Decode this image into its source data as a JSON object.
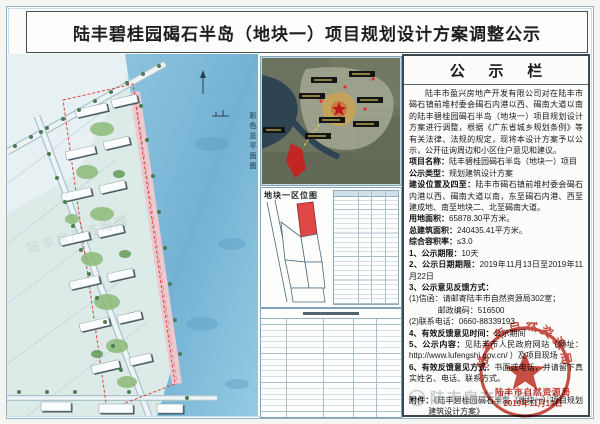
{
  "poster": {
    "title": "陆丰碧桂园碣石半岛（地块一）项目规划设计方案调整公示"
  },
  "site_plan": {
    "vertical_label": "彩色总平面图",
    "watermark_text": "陆丰房产咨询网"
  },
  "middle": {
    "sketch_label": "地块一区位图"
  },
  "notice": {
    "title": "公 示 栏",
    "lines": [
      {
        "b": "",
        "t": "陆丰市盈兴房地产开发有限公司对在陆丰市碣石镇前堆村委会碣石内港以西、碣南大道以南的陆丰碧桂园碣石半岛（地块一）项目规划设计方案进行调整，根据《广东省城乡规划条例》等有关法律、法规的规定，现将本设计方案予以公示，公开征询周边和小区住户意见和建议。"
      },
      {
        "b": "项目名称：",
        "t": "陆丰碧桂园碣石半岛（地块一）项目"
      },
      {
        "b": "公示类型：",
        "t": "规划建筑设计方案"
      },
      {
        "b": "建设位置及四至：",
        "t": "陆丰市碣石镇前堆村委会碣石内港以西、碣南大道以南，东至碣石内港、西至建成地、南至地块二、北至碣南大道。"
      },
      {
        "b": "用地面积：",
        "t": "65878.30平方米。"
      },
      {
        "b": "总建筑面积：",
        "t": "240435.41平方米。"
      },
      {
        "b": "综合容积率：",
        "t": "≤3.0"
      },
      {
        "b": "1、公示期限：",
        "t": "10天"
      },
      {
        "b": "2、公示日期期限：",
        "t": "2019年11月13日至2019年11月22日"
      },
      {
        "b": "3、公示意见反馈方式：",
        "t": ""
      },
      {
        "b": "",
        "t": "(1)信函：请邮寄陆丰市自然资源局302室；"
      },
      {
        "b": "",
        "t": "邮政编码：516500"
      },
      {
        "b": "",
        "t": "(2)联系电话：0660-88339193"
      },
      {
        "b": "4、有效反馈意见时间：",
        "t": "公示期间"
      },
      {
        "b": "5、公示内容：",
        "t": "见陆丰市人民政府网站（网址： http://www.lufengshi.gov.cn/ ）及项目现场"
      },
      {
        "b": "6、有效反馈意见方式：",
        "t": "书面或电话，并请留下真实姓名、电话、联系方式。"
      }
    ],
    "attachment_label": "附件：",
    "attachment_text": "《陆丰碧桂园碣石半岛（地块一）项目规划建筑设计方案》",
    "seal": {
      "agency": "陆丰市自然资源局",
      "date": "2019年11月13日"
    }
  },
  "watermark": {
    "text": "陆丰房产咨询中心"
  },
  "colors": {
    "seal_red": "#c1362a",
    "site_red": "#d9453c",
    "frame_blue": "#8fb2c6",
    "sea_blue": "#79b7d8"
  }
}
